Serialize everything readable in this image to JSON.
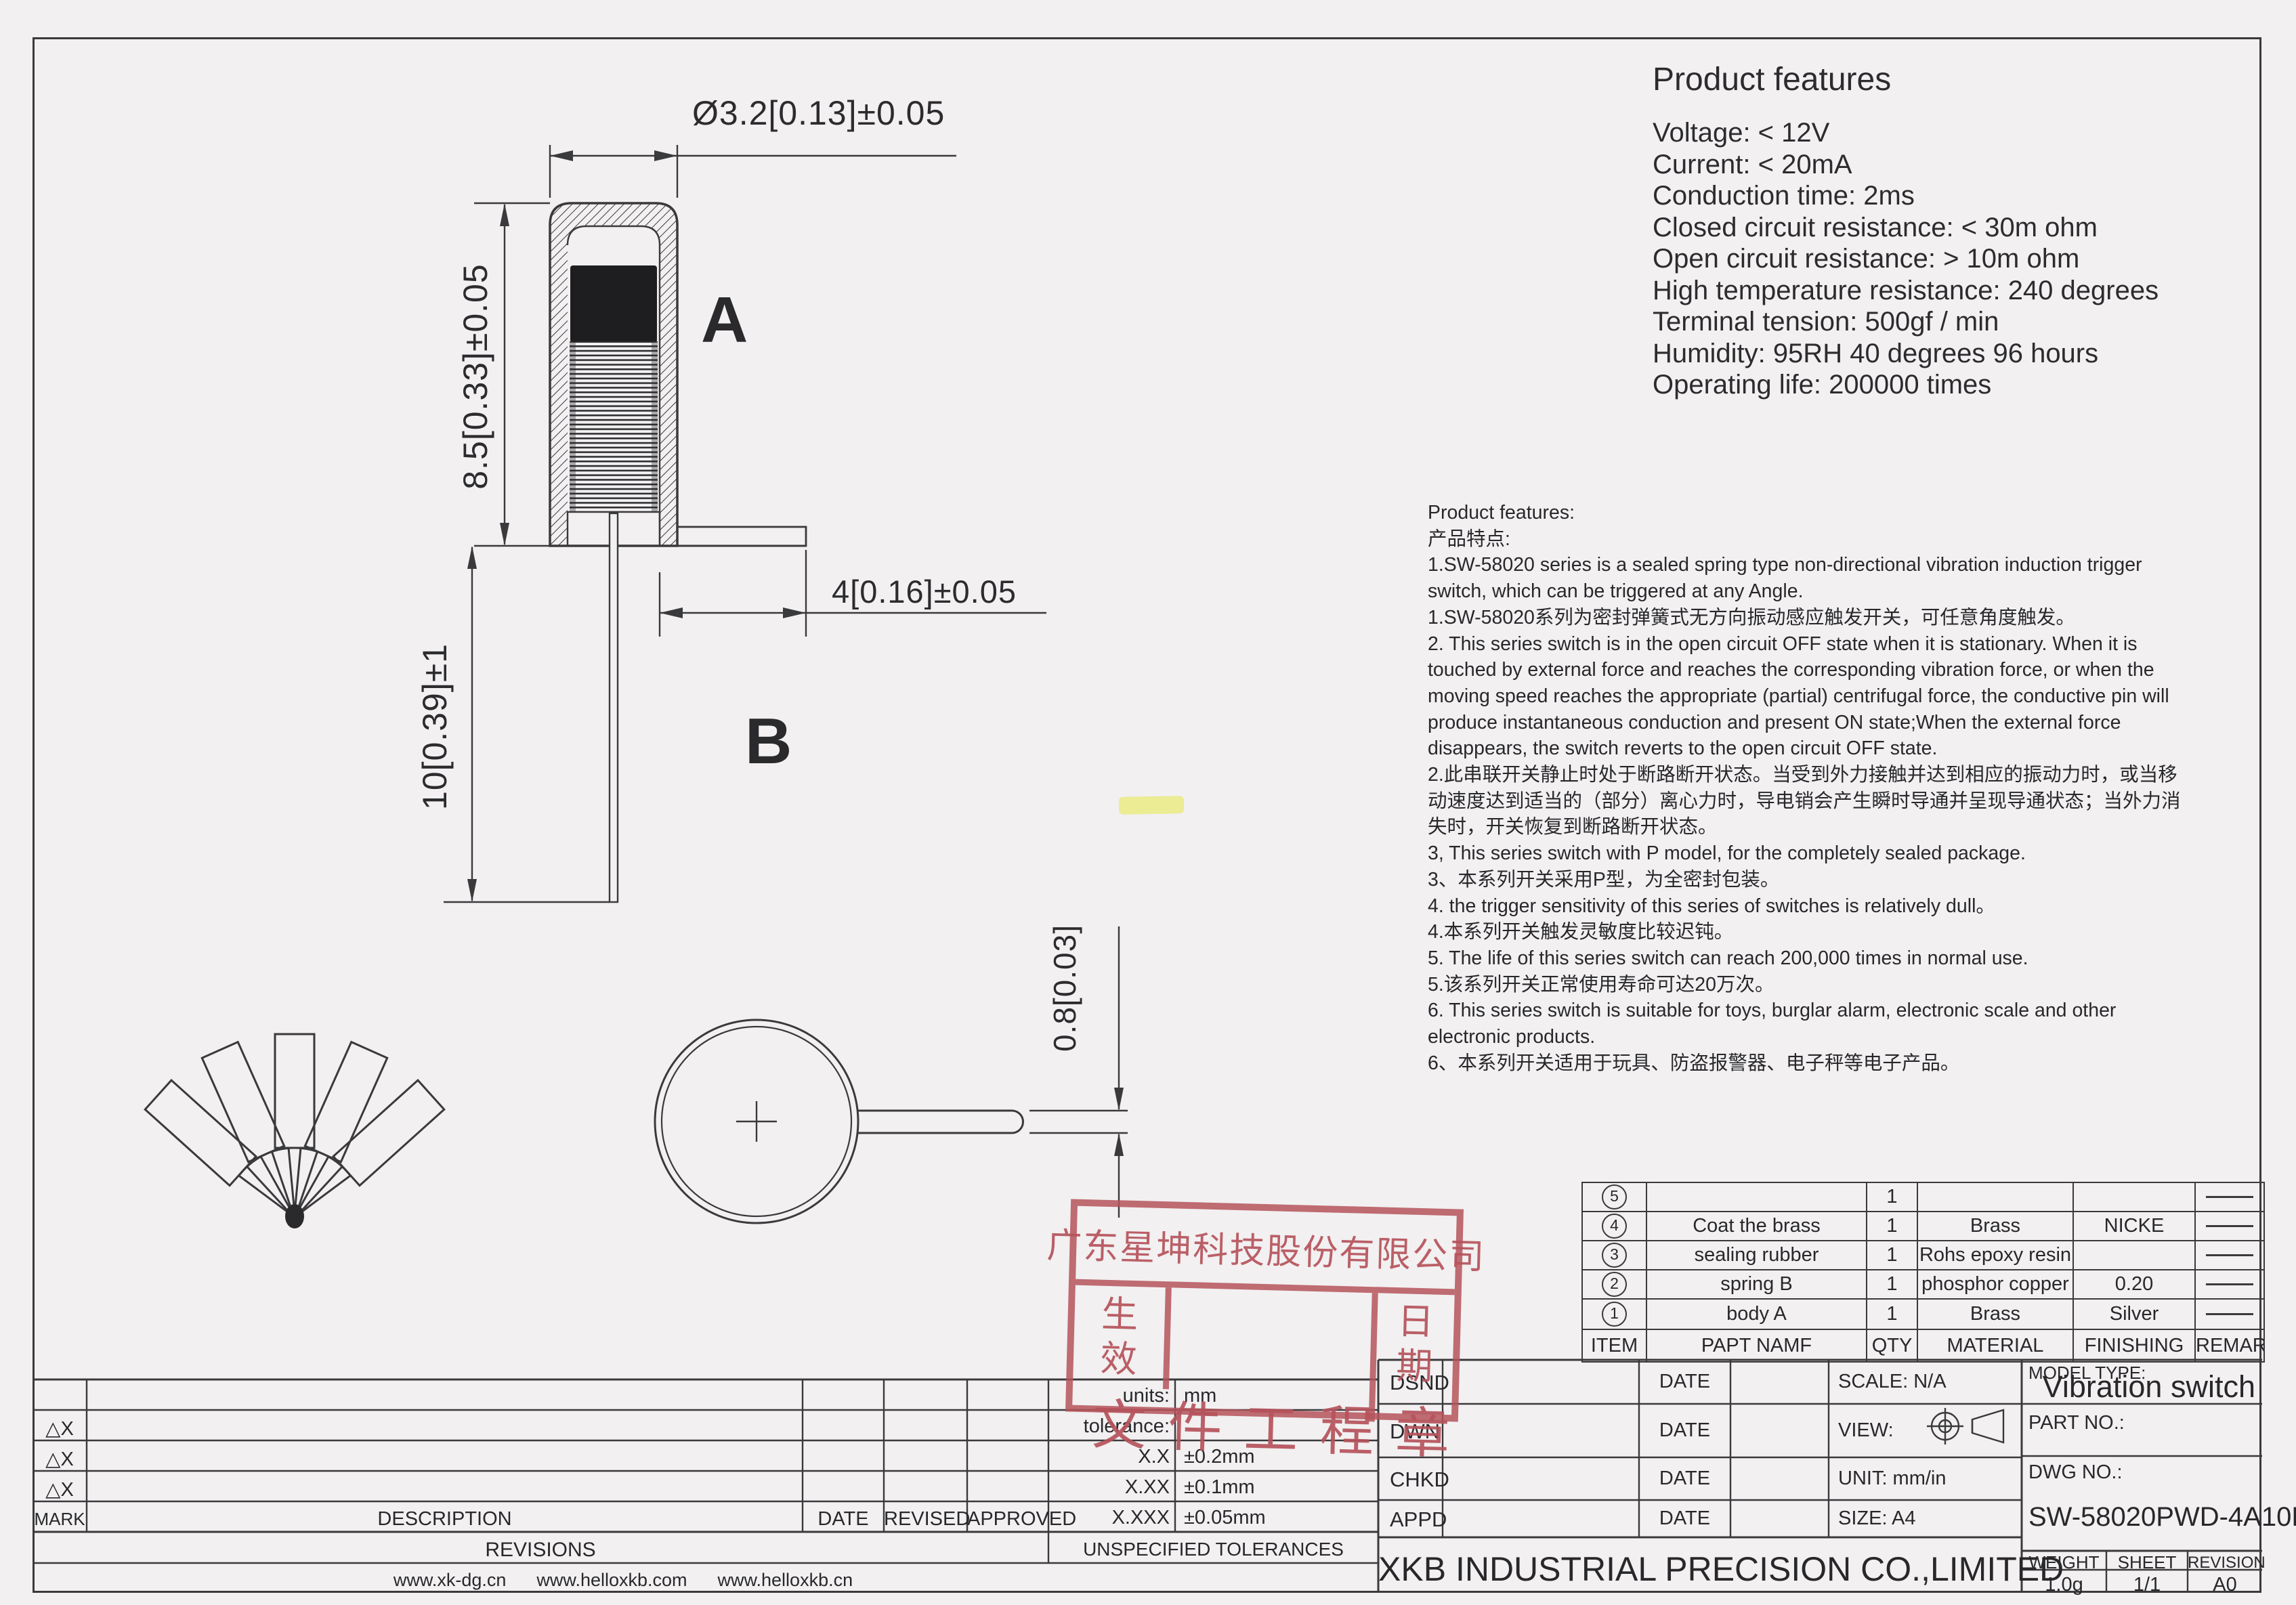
{
  "colors": {
    "paper": "#f2f0f1",
    "ink": "#3a3a3c",
    "stamp_red": "#b5535b",
    "highlight": "#e4e838"
  },
  "drawing": {
    "dim_diameter": "Ø3.2[0.13]±0.05",
    "dim_height": "8.5[0.33]±0.05",
    "dim_pin_length": "10[0.39]±1",
    "dim_flange": "4[0.16]±0.05",
    "dim_pin_width": "0.8[0.03]",
    "label_a": "A",
    "label_b": "B"
  },
  "features_panel": {
    "title": "Product features",
    "lines": [
      "Voltage: < 12V",
      "Current: < 20mA",
      "Conduction time: 2ms",
      "Closed circuit resistance: < 30m ohm",
      "Open circuit resistance: > 10m ohm",
      "High temperature resistance: 240 degrees",
      "Terminal tension: 500gf / min",
      "Humidity: 95RH 40 degrees 96 hours",
      "Operating life: 200000 times"
    ]
  },
  "description": {
    "lines": [
      "Product features:",
      "产品特点:",
      "1.SW-58020 series is a sealed spring type non-directional vibration induction trigger",
      "switch, which can be triggered at any Angle.",
      "1.SW-58020系列为密封弹簧式无方向振动感应触发开关，可任意角度触发。",
      "2. This series switch is in the open circuit OFF state when it is stationary. When it is",
      "touched by external force and reaches the corresponding vibration force, or when the",
      "moving speed reaches the appropriate (partial) centrifugal force, the conductive pin will",
      "produce instantaneous conduction and present ON state;When the external force",
      "disappears, the switch reverts to the open circuit OFF state.",
      "2.此串联开关静止时处于断路断开状态。当受到外力接触并达到相应的振动力时，或当移",
      "动速度达到适当的（部分）离心力时，导电销会产生瞬时导通并呈现导通状态；当外力消",
      "失时，开关恢复到断路断开状态。",
      "3, This series switch with P model, for the completely sealed package.",
      "3、本系列开关采用P型，为全密封包装。",
      "4. the trigger sensitivity of this series of switches is relatively dull。",
      "4.本系列开关触发灵敏度比较迟钝。",
      "5. The life of this series switch can reach 200,000 times in normal use.",
      "5.该系列开关正常使用寿命可达20万次。",
      "6. This series switch is suitable for toys, burglar alarm, electronic scale and other",
      "electronic products.",
      "6、本系列开关适用于玩具、防盗报警器、电子秤等电子产品。"
    ]
  },
  "stamp": {
    "company": "广东星坤科技股份有限公司",
    "effective_1": "生",
    "effective_2": "效",
    "date_1": "日",
    "date_2": "期",
    "bottom": "文件工程章"
  },
  "parts_table": {
    "headers": {
      "item": "ITEM",
      "name": "PAPT NAMF",
      "qty": "QTY",
      "material": "MATERIAL",
      "finishing": "FINISHING",
      "remark": "REMARK"
    },
    "rows": [
      {
        "item": "5",
        "name": "",
        "qty": "1",
        "material": "",
        "finishing": ""
      },
      {
        "item": "4",
        "name": "Coat the brass",
        "qty": "1",
        "material": "Brass",
        "finishing": "NICKE"
      },
      {
        "item": "3",
        "name": "sealing rubber",
        "qty": "1",
        "material": "Rohs epoxy resin",
        "finishing": ""
      },
      {
        "item": "2",
        "name": "spring  B",
        "qty": "1",
        "material": "phosphor copper",
        "finishing": "0.20"
      },
      {
        "item": "1",
        "name": "body  A",
        "qty": "1",
        "material": "Brass",
        "finishing": "Silver"
      }
    ]
  },
  "revisions_table": {
    "mark_symbol": "△X",
    "mark": "MARK",
    "description": "DESCRIPTION",
    "date": "DATE",
    "revised": "REVISED",
    "approved": "APPROVED",
    "title": "REVISIONS",
    "websites": "www.xk-dg.cn      www.helloxkb.com      www.helloxkb.cn"
  },
  "tolerances": {
    "units_label": "units:",
    "units_value": "mm",
    "tolerance_label": "tolerance:",
    "rows": [
      {
        "label": "X.X",
        "value": "±0.2mm"
      },
      {
        "label": "X.XX",
        "value": "±0.1mm"
      },
      {
        "label": "X.XXX",
        "value": "±0.05mm"
      }
    ],
    "unspecified": "UNSPECIFIED TOLERANCES"
  },
  "title_block": {
    "dsnd": "DSND",
    "dwn": "DWN",
    "chkd": "CHKD",
    "appd": "APPD",
    "date_label": "DATE",
    "scale": "SCALE: N/A",
    "view": "VIEW:",
    "unit": "UNIT: mm/in",
    "size": "SIZE: A4",
    "model_type_label": "MODEL TYPE:",
    "model_type": "Vibration switch",
    "part_no_label": "PART NO.:",
    "dwg_no_label": "DWG NO.:",
    "dwg_no": "SW-58020PWD-4A10B3",
    "company": "XKB INDUSTRIAL PRECISION CO.,LIMITED",
    "weight_label": "WEIGHT",
    "sheet_label": "SHEET",
    "revision_label": "REVISION",
    "weight": "1.0g",
    "sheet": "1/1",
    "revision": "A0"
  }
}
